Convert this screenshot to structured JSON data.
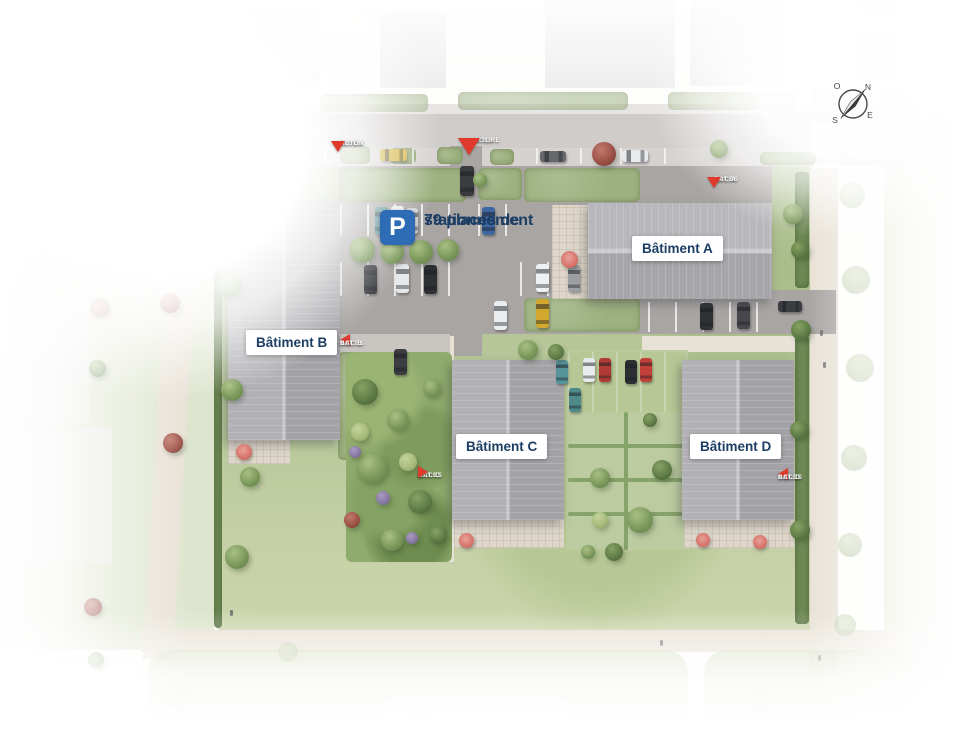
{
  "plan": {
    "street_label": "BOULEVARD",
    "parking_sign": {
      "icon_letter": "P",
      "line1": "79 places de",
      "line2": "stationnement"
    },
    "buildings": [
      {
        "id": "A",
        "label": "Bâtiment A"
      },
      {
        "id": "B",
        "label": "Bâtiment B"
      },
      {
        "id": "C",
        "label": "Bâtiment C"
      },
      {
        "id": "D",
        "label": "Bâtiment D"
      }
    ],
    "access_points": [
      {
        "id": "pieton",
        "line1": "ACCES",
        "line2": "PIETON",
        "direction": "down"
      },
      {
        "id": "voiture",
        "line1": "ACCES",
        "line2": "VOITURE",
        "direction": "down"
      },
      {
        "id": "bat-a",
        "line1": "ACCES",
        "line2": "BAT. A",
        "direction": "down"
      },
      {
        "id": "bat-b",
        "line1": "ACCES",
        "line2": "BAT. B",
        "direction": "left"
      },
      {
        "id": "bat-c",
        "line1": "ACCES",
        "line2": "BAT. C",
        "direction": "right"
      },
      {
        "id": "bat-d",
        "line1": "ACCES",
        "line2": "BAT. D",
        "direction": "left"
      }
    ],
    "compass": {
      "north": "N",
      "east": "E",
      "south": "S",
      "west": "O"
    },
    "colors": {
      "access_red": "#e03a2c",
      "parking_blue": "#2e6cb5",
      "label_navy": "#1c3e64"
    }
  }
}
